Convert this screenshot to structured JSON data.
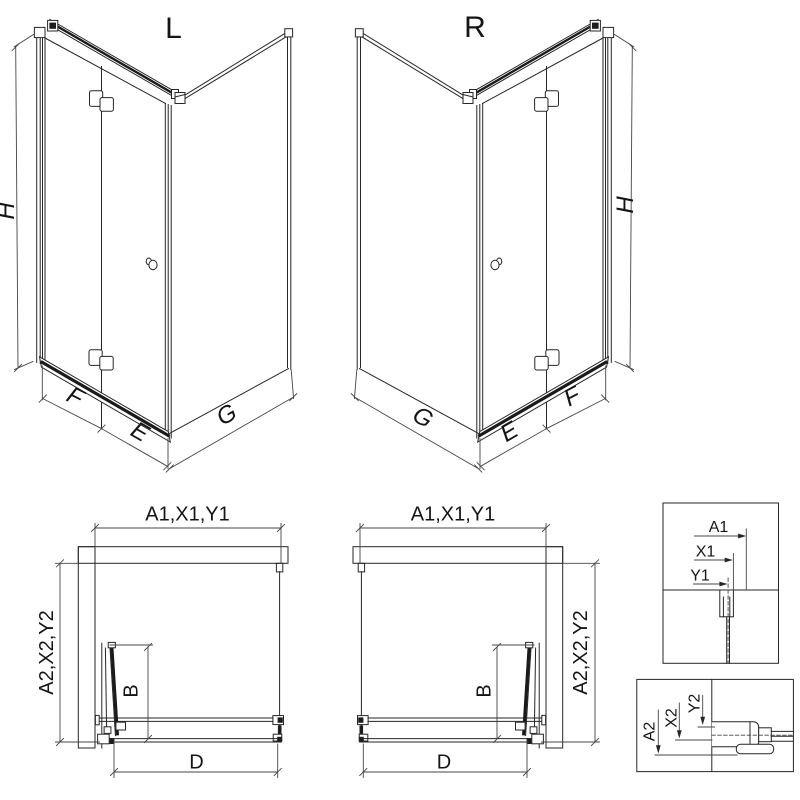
{
  "iso_left": {
    "variant": "L",
    "dim_h": "H",
    "dim_f": "F",
    "dim_e": "E",
    "dim_g": "G"
  },
  "iso_right": {
    "variant": "R",
    "dim_h": "H",
    "dim_f": "F",
    "dim_e": "E",
    "dim_g": "G"
  },
  "plan_left": {
    "dim_top": "A1,X1,Y1",
    "dim_side": "A2,X2,Y2",
    "dim_b": "B",
    "dim_d": "D"
  },
  "plan_right": {
    "dim_top": "A1,X1,Y1",
    "dim_side": "A2,X2,Y2",
    "dim_b": "B",
    "dim_d": "D"
  },
  "detail_top": {
    "dim_a1": "A1",
    "dim_x1": "X1",
    "dim_y1": "Y1"
  },
  "detail_bottom": {
    "dim_a2": "A2",
    "dim_x2": "X2",
    "dim_y2": "Y2"
  },
  "colors": {
    "line": "#262626",
    "dark_fill": "#1d1d1d",
    "background": "#ffffff"
  }
}
